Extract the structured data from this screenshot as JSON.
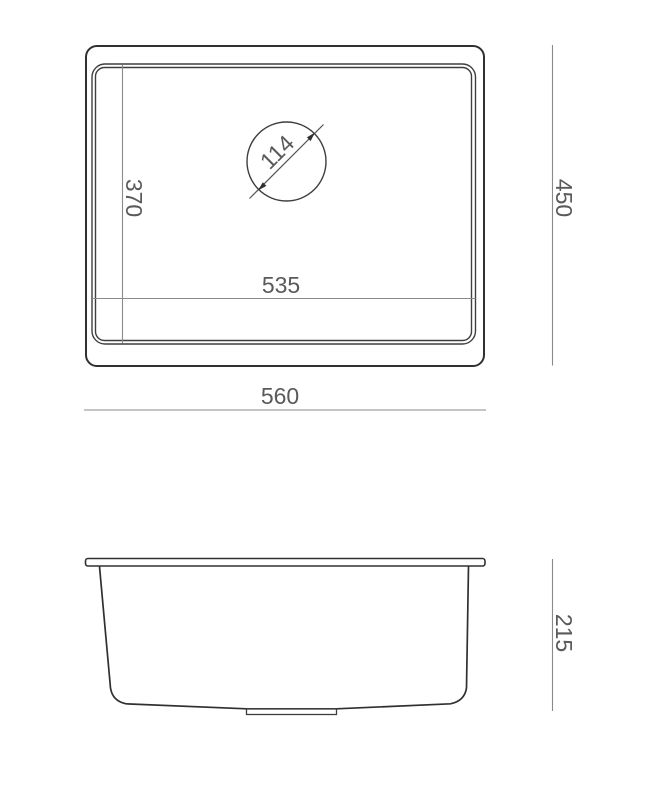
{
  "title": "Undermount sink dimension drawing",
  "colors": {
    "background": "#ffffff",
    "outline": "#303030",
    "rim_line": "#3e3e3e",
    "dimension_line": "#8a8a8a",
    "text": "#5a5a5a"
  },
  "top_view": {
    "overall_width_label": "560",
    "overall_depth_label": "450",
    "bowl_width_label": "535",
    "bowl_depth_label": "370",
    "drain_diameter_label": "114"
  },
  "side_view": {
    "height_label": "215"
  }
}
